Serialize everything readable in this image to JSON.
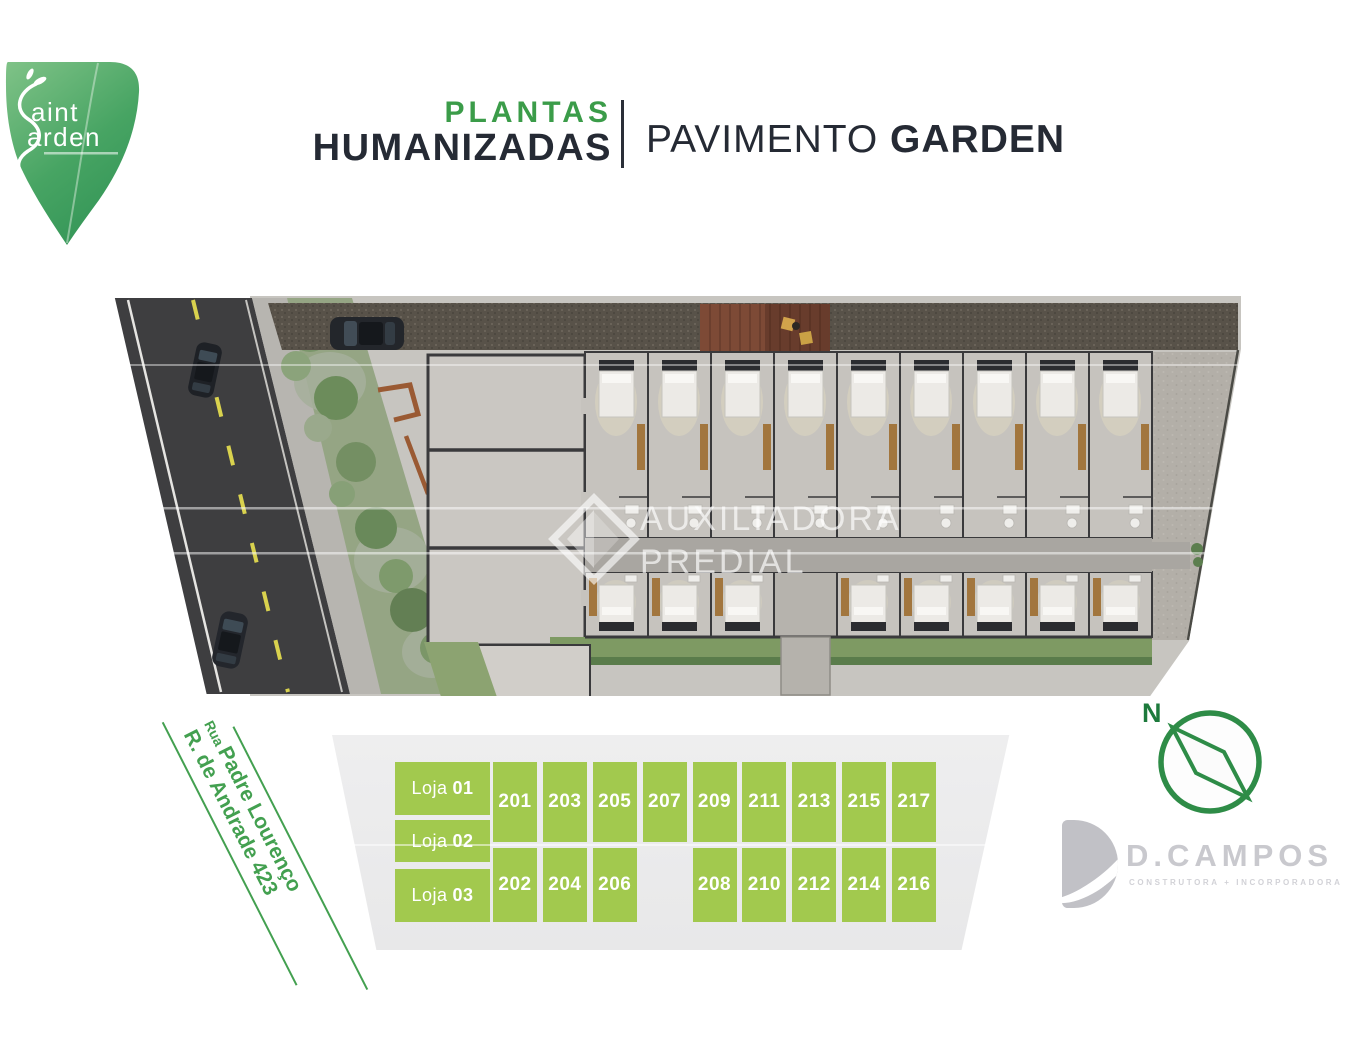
{
  "brand": {
    "logo_text_top": "aint",
    "logo_text_bottom": "arden"
  },
  "header": {
    "plantas": "PLANTAS",
    "humanizadas": "HUMANIZADAS",
    "pavimento": "PAVIMENTO ",
    "garden": "GARDEN"
  },
  "watermark": {
    "line1": "AUXILIADORA",
    "line2": "PREDIAL"
  },
  "street": {
    "rua": "Rua ",
    "line1": "Padre Lourenço",
    "line2": "R. de Andrade 423"
  },
  "compass": {
    "north": "N"
  },
  "developer": {
    "name": "D.CAMPOS",
    "tagline": "CONSTRUTORA + INCORPORADORA"
  },
  "legend": {
    "lojas": [
      {
        "label": "Loja",
        "num": "01"
      },
      {
        "label": "Loja",
        "num": "02"
      },
      {
        "label": "Loja",
        "num": "03"
      }
    ],
    "top_row": [
      "201",
      "203",
      "205",
      "207",
      "209",
      "211",
      "213",
      "215",
      "217"
    ],
    "bottom_row": [
      "202",
      "204",
      "206",
      "208",
      "210",
      "212",
      "214",
      "216"
    ]
  },
  "colors": {
    "brand_green": "#3b9c49",
    "legend_green": "#a2c94e",
    "street_green": "#43a050",
    "compass_green": "#2e8c47",
    "title_dark": "#252a34",
    "developer_gray": "#c9c9ce"
  }
}
